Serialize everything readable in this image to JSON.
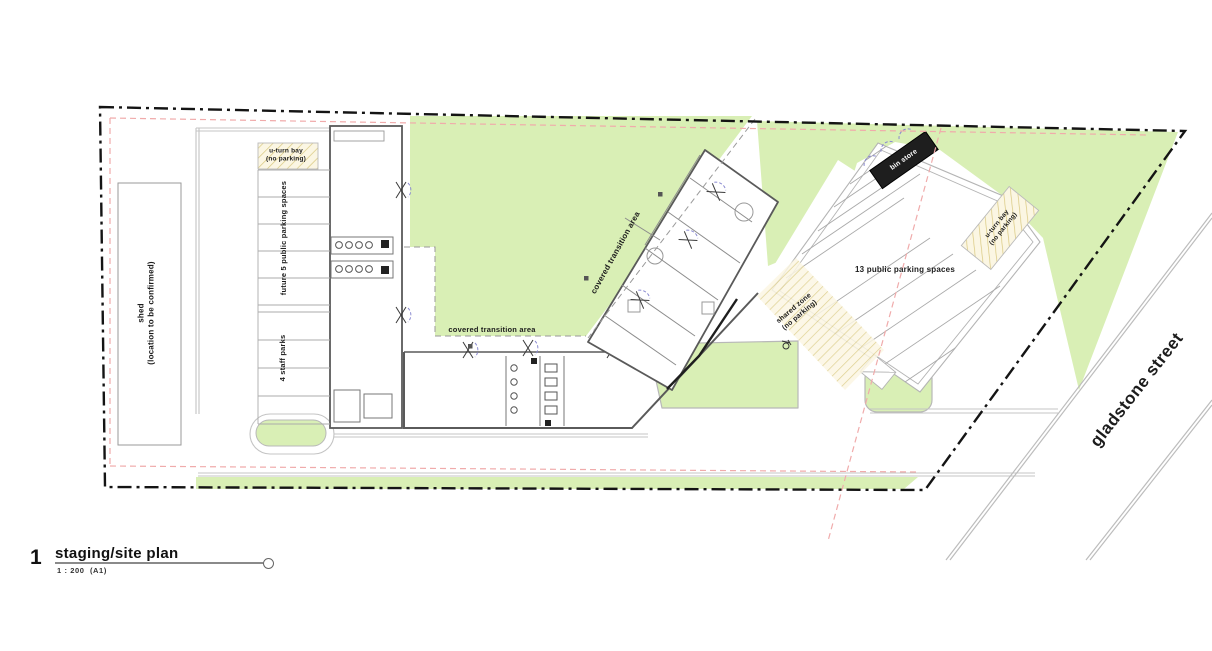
{
  "plan": {
    "labels": {
      "shed_line1": "shed",
      "shed_line2": "(location to be confirmed)",
      "future_parking": "future 5 public parking spaces",
      "staff_parks": "4 staff parks",
      "uturn_line1": "u-turn bay",
      "uturn_line2": "(no parking)",
      "covered_transition": "covered transition area",
      "public_parking": "13 public parking spaces",
      "shared_line1": "shared zone",
      "shared_line2": "(no parking)",
      "bin_store": "bin store",
      "street_name": "gladstone street"
    },
    "title_block": {
      "number": "1",
      "title": "staging/site plan",
      "scale": "1 : 200",
      "sheet": "(A1)"
    },
    "colors": {
      "lawn_green": "#d9efb5",
      "boundary_black": "#141414",
      "setback_red": "#f0abab",
      "hatch_tan": "#d9c87e"
    }
  }
}
